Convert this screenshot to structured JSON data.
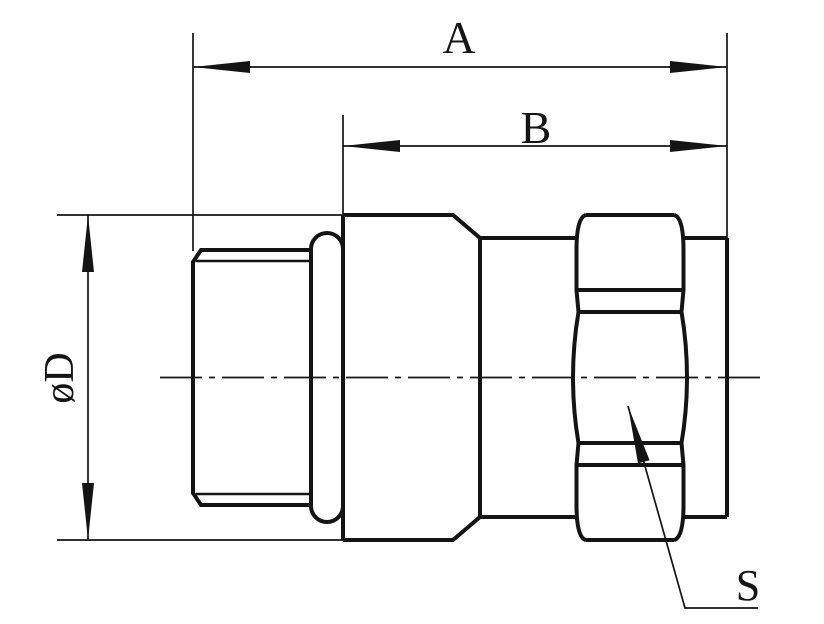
{
  "drawing": {
    "labels": {
      "dim_a": "A",
      "dim_b": "B",
      "dim_diameter": "øD",
      "hex_flats": "S"
    },
    "colors": {
      "line": "#141414",
      "background": "#ffffff"
    }
  }
}
